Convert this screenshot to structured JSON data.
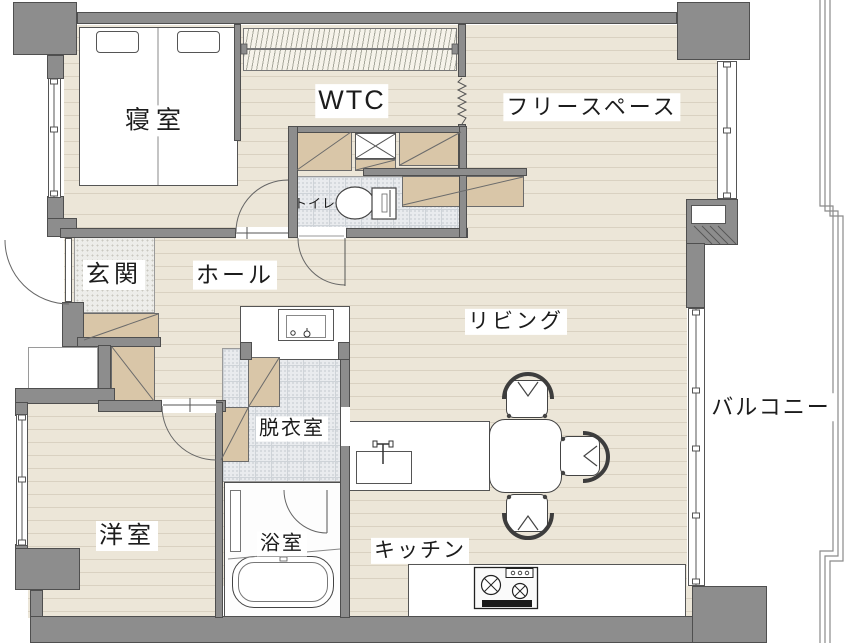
{
  "rooms": {
    "bedroom": "寝室",
    "wtc": "WTC",
    "free_space": "フリースペース",
    "toilet": "トイレ",
    "entrance": "玄関",
    "hall": "ホール",
    "living": "リビング",
    "dressing": "脱衣室",
    "western_room": "洋室",
    "bath": "浴室",
    "kitchen": "キッチン",
    "balcony": "バルコニー"
  },
  "colors": {
    "wall": "#8d8d8d",
    "wall_edge": "#4f4f4f",
    "floor": "#ece6d8",
    "plank_line": "#d9d1c1",
    "closet": "#d9c6a8",
    "tile": "#e9ebee",
    "fixture": "#ffffff"
  },
  "icons": [
    "double-bed-icon",
    "pillow-icon",
    "hanger-rod-icon",
    "toilet-icon",
    "washbasin-icon",
    "bathtub-icon",
    "kitchen-sink-icon",
    "gas-stove-icon",
    "dining-table-icon",
    "chair-icon",
    "door-swing-icon",
    "window-icon",
    "closet-icon",
    "accordion-curtain-icon",
    "balcony-railing-icon"
  ]
}
